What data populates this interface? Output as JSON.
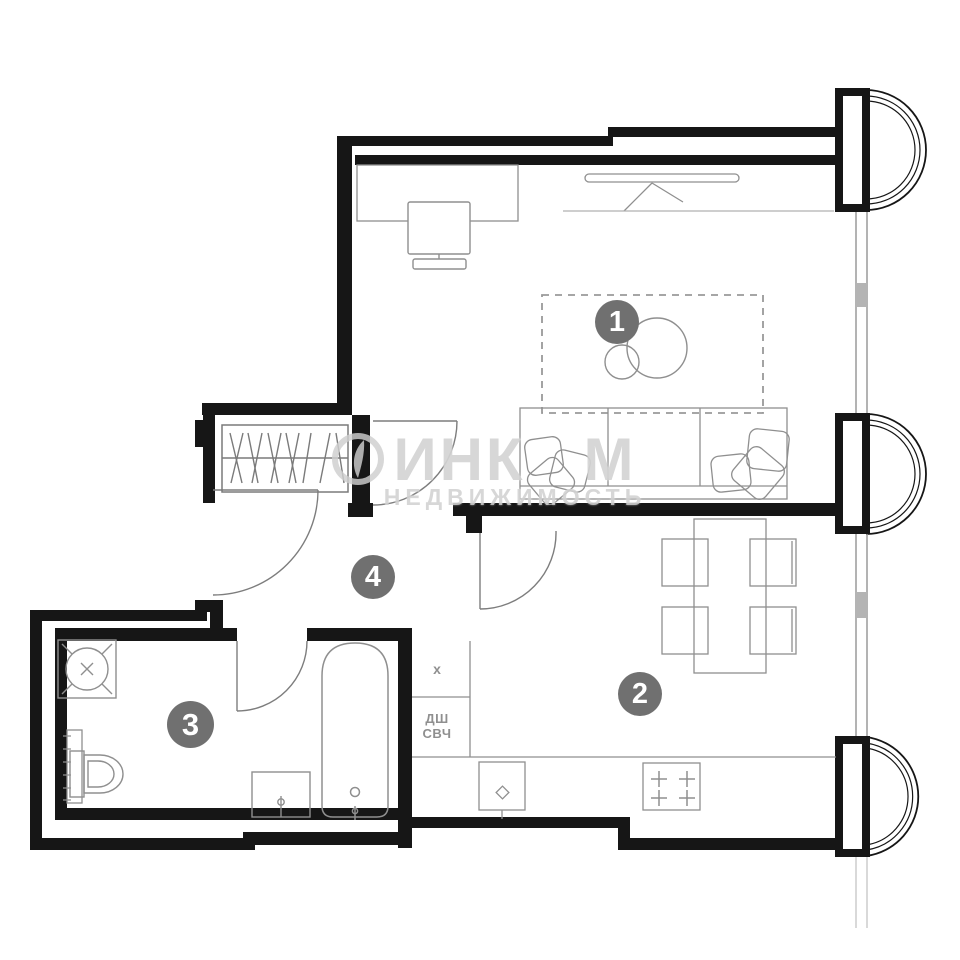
{
  "watermark": {
    "part1": "ИНК",
    "part2": "М",
    "line2": "НЕДВИЖИМОСТЬ"
  },
  "badges": {
    "room1": "1",
    "room2": "2",
    "room3": "3",
    "room4": "4"
  },
  "closet": {
    "top": "х",
    "mid1": "ДШ",
    "mid2": "СВЧ"
  },
  "colors": {
    "wall": "#161616",
    "furniture_line": "#8f8f8f",
    "door_line": "#7d7d7d",
    "badge_bg": "#707070",
    "badge_text": "#ffffff",
    "watermark": "#cecece",
    "glazing_gray": "#b4b4b4"
  }
}
